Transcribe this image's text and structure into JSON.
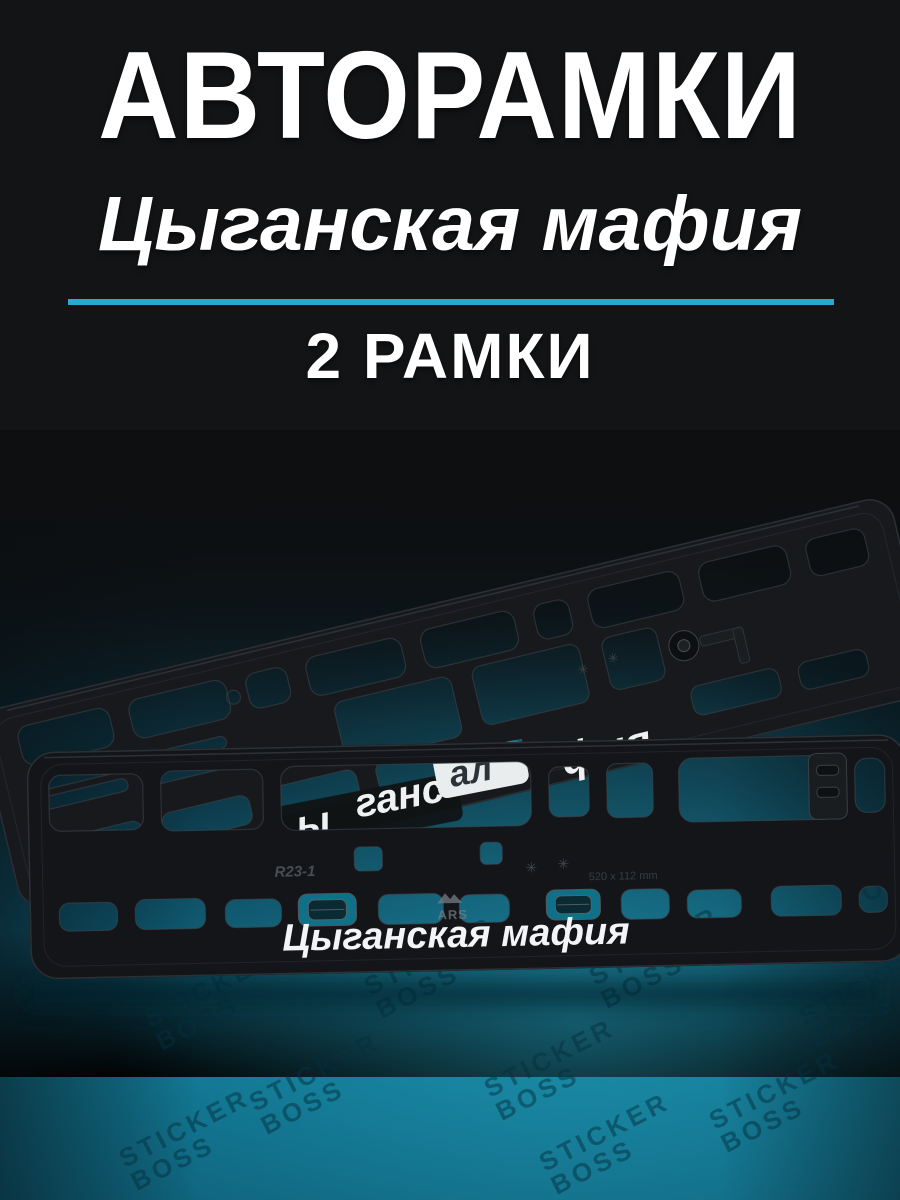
{
  "header": {
    "title": "АВТОРАМКИ",
    "subtitle": "Цыганская мафия",
    "count": "2 РАМКИ"
  },
  "scene": {
    "frame_front": {
      "caption": "Цыганская мафия",
      "model_mark": "R23-1",
      "size_mark": "520 x 112 mm",
      "brand_mark": "ARS"
    },
    "frame_back": {
      "model_mark": "R23-1",
      "caption_fragment": "фия"
    },
    "showthrough": {
      "fragment_left": "ы",
      "fragment_mid": "ганс",
      "fragment_right": "ал"
    },
    "watermark": {
      "line1": "STICKER",
      "line2": "BOSS"
    }
  },
  "colors": {
    "divider": "#2aa9ce",
    "page_background": "#131416",
    "teal_glow": "#10738e",
    "plastic": "#141619",
    "caption_white": "#f3f4f5"
  }
}
